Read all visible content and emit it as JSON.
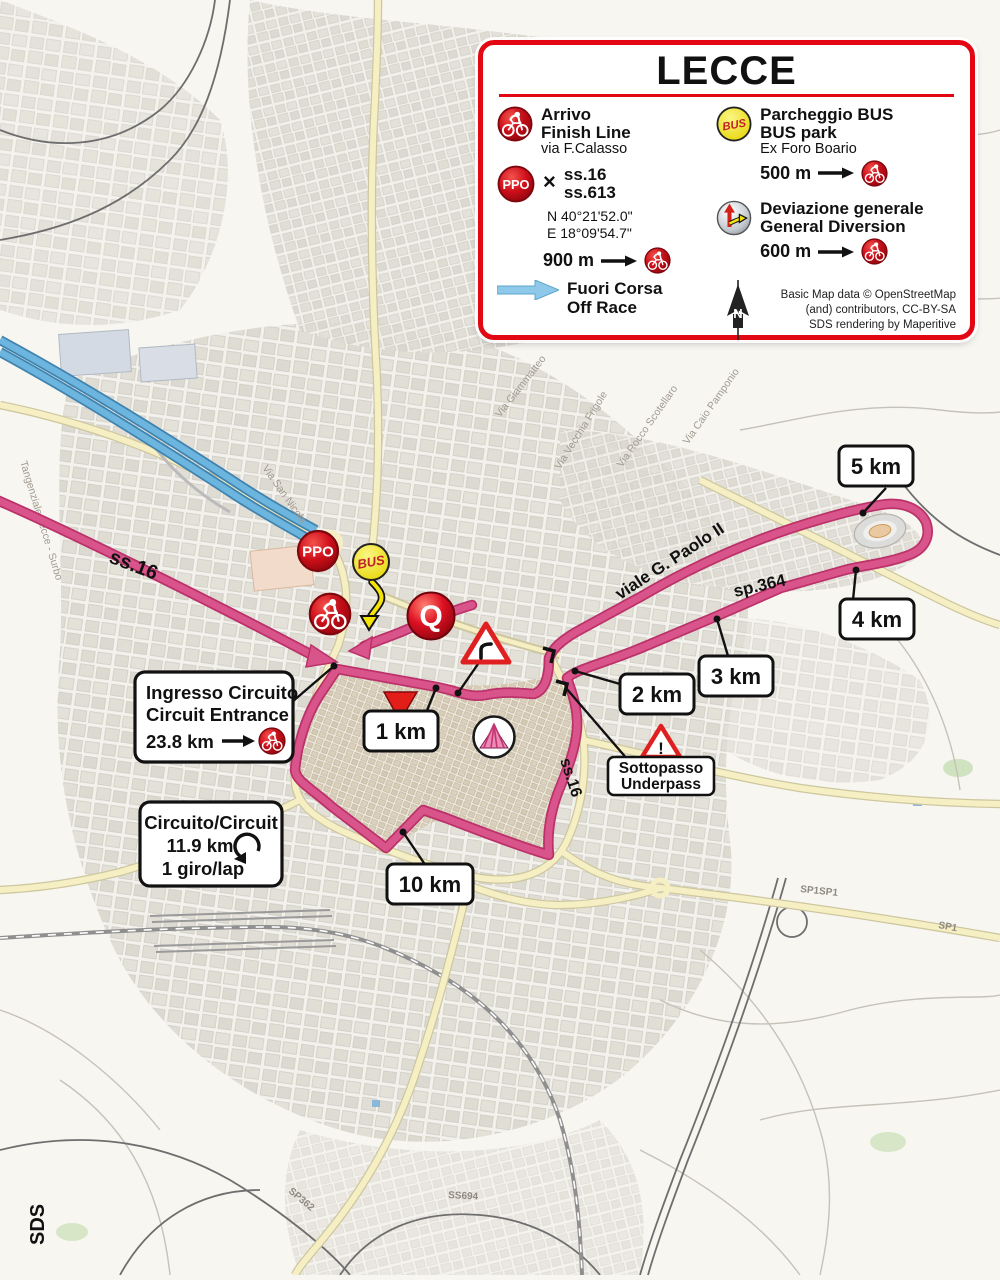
{
  "colors": {
    "route_pink": "#d0457c",
    "legend_red": "#e30613",
    "motorway_blue": "#6cb5de",
    "bus_yellow": "#f2e51c",
    "warning_red": "#e02020"
  },
  "legend": {
    "title": "LECCE",
    "arrivo": {
      "line1": "Arrivo",
      "line2": "Finish Line",
      "line3": "via F.Calasso"
    },
    "ppo": {
      "cross": "×",
      "road1": "ss.16",
      "road2": "ss.613",
      "lat": "N 40°21'52.0\"",
      "lon": "E 18°09'54.7\"",
      "dist": "900 m"
    },
    "fuori": {
      "line1": "Fuori Corsa",
      "line2": "Off Race"
    },
    "bus": {
      "line1": "Parcheggio BUS",
      "line2": "BUS park",
      "line3": "Ex Foro Boario",
      "dist": "500 m"
    },
    "deviazione": {
      "line1": "Deviazione generale",
      "line2": "General Diversion",
      "dist": "600 m"
    },
    "compass_n": "N",
    "attribution": {
      "line1": "Basic Map data © OpenStreetMap",
      "line2": "(and) contributors, CC-BY-SA",
      "line3": "SDS rendering by Maperitive"
    }
  },
  "map": {
    "markers": {
      "ppo": "PPO",
      "bus": "BUS",
      "q": "Q"
    },
    "km_labels": {
      "km1": "1 km",
      "km2": "2 km",
      "km3": "3 km",
      "km4": "4 km",
      "km5": "5 km",
      "km10": "10 km"
    },
    "boxes": {
      "ingresso": {
        "line1": "Ingresso Circuito",
        "line2": "Circuit Entrance",
        "distance": "23.8 km"
      },
      "circuito": {
        "line1": "Circuito/Circuit",
        "line2": "11.9 km",
        "line3": "1 giro/lap"
      },
      "sottopasso": {
        "line1": "Sottopasso",
        "line2": "Underpass"
      }
    },
    "roads": {
      "ss16_nw": "ss.16",
      "ss16_south": "ss.16",
      "sp364": "sp.364",
      "viale_gpaolo": "viale G. Paolo II"
    },
    "minor_labels": {
      "ss101": "SS101",
      "sp1sp1": "SP1SP1",
      "sp1": "SP1",
      "ss694": "SS694",
      "sp362": "SP362"
    },
    "street_labels": {
      "frigole": "Via Vecchia Frigole",
      "scotellaro": "Via Rocco Scotellaro",
      "pamponio": "Via Caio Pamponio",
      "sannicola": "Via San Nicola",
      "tangenziale": "Tangenziale Lecce - Surbo",
      "giammatteo": "Via Giammatteo"
    },
    "watermark": "SDS"
  }
}
